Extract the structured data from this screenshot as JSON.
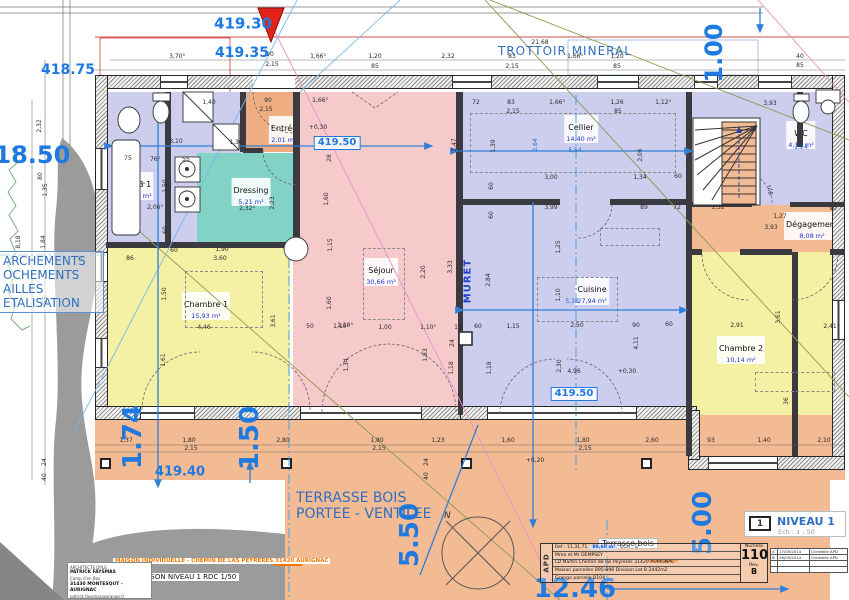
{
  "colors": {
    "lavender": "#cdcdee",
    "pink": "#f6caca",
    "yellow": "#f5f1a4",
    "teal": "#82d2c5",
    "salmon": "#f3bb94",
    "salmon_dark": "#efae82",
    "blue": "#1d6fd6"
  },
  "labels": {
    "trottoir": "TROTTOIR MINERAL",
    "muret": "MURET",
    "terrasse_line1": "TERRASSE BOIS",
    "terrasse_line2": "PORTEE - VENTILEE",
    "compass_n": "N",
    "left_box": [
      "ARCHEMENTS",
      "OCHEMENTS",
      "AILLES",
      "ETALISATION"
    ]
  },
  "rooms": [
    {
      "key": "sdb1",
      "name": "SDB 1",
      "area": "9,16 m²",
      "color": "lavender",
      "x": 106,
      "y": 92,
      "w": 62,
      "h": 153,
      "lx": 139,
      "ly": 186
    },
    {
      "key": "hall",
      "color": "lavender",
      "x": 168,
      "y": 92,
      "w": 75,
      "h": 61
    },
    {
      "key": "washcol",
      "color": "lavender",
      "x": 168,
      "y": 153,
      "w": 29,
      "h": 97
    },
    {
      "key": "dressing",
      "name": "Dressing",
      "area": "5,21 m²",
      "color": "teal",
      "x": 197,
      "y": 153,
      "w": 96,
      "h": 97,
      "lx": 251,
      "ly": 192
    },
    {
      "key": "entree",
      "name": "Entrée",
      "area": "2,01 m²",
      "color": "salmon_dark",
      "x": 243,
      "y": 92,
      "w": 57,
      "h": 60,
      "lx": 284,
      "ly": 130
    },
    {
      "key": "sejour",
      "name": "Séjour",
      "area": "30,66 m²",
      "color": "pink",
      "x": 293,
      "y": 92,
      "w": 167,
      "h": 323,
      "lx": 381,
      "ly": 272
    },
    {
      "key": "cellier",
      "name": "Cellier",
      "area": "14,40 m²",
      "color": "lavender",
      "x": 460,
      "y": 92,
      "w": 230,
      "h": 110,
      "lx": 581,
      "ly": 129
    },
    {
      "key": "cuisine",
      "name": "Cuisine",
      "area": "27,94 m²",
      "color": "lavender",
      "x": 460,
      "y": 202,
      "w": 230,
      "h": 213,
      "lx": 592,
      "ly": 291
    },
    {
      "key": "wc",
      "name": "WC",
      "area": "4,11 m²",
      "color": "lavender",
      "x": 690,
      "y": 92,
      "w": 151,
      "h": 113,
      "lx": 801,
      "ly": 135
    },
    {
      "key": "degagement",
      "name": "Dégagement",
      "area": "8,08 m²",
      "color": "salmon",
      "x": 690,
      "y": 205,
      "w": 151,
      "h": 47,
      "lx": 812,
      "ly": 226
    },
    {
      "key": "chambre2",
      "name": "Chambre 2",
      "area": "10,14 m²",
      "color": "yellow",
      "x": 690,
      "y": 252,
      "w": 102,
      "h": 204,
      "lx": 741,
      "ly": 350
    },
    {
      "key": "chambre2b",
      "color": "yellow",
      "x": 798,
      "y": 252,
      "w": 43,
      "h": 204
    },
    {
      "key": "chambre1",
      "name": "Chambre 1",
      "area": "15,93 m²",
      "color": "yellow",
      "x": 106,
      "y": 245,
      "w": 184,
      "h": 170,
      "lx": 206,
      "ly": 306
    },
    {
      "key": "terrasse-band",
      "color": "salmon",
      "x": 95,
      "y": 415,
      "w": 750,
      "h": 65
    },
    {
      "key": "terrasse-main",
      "color": "salmon",
      "x": 285,
      "y": 480,
      "w": 545,
      "h": 120
    }
  ],
  "walls": {
    "outer": [
      {
        "x": 95,
        "y": 75,
        "w": 750,
        "h": 14
      },
      {
        "x": 95,
        "y": 75,
        "w": 13,
        "h": 345
      },
      {
        "x": 95,
        "y": 406,
        "w": 375,
        "h": 14
      },
      {
        "x": 460,
        "y": 406,
        "w": 237,
        "h": 14
      },
      {
        "x": 832,
        "y": 75,
        "w": 13,
        "h": 395
      },
      {
        "x": 688,
        "y": 456,
        "w": 157,
        "h": 14
      },
      {
        "x": 688,
        "y": 410,
        "w": 12,
        "h": 50
      }
    ],
    "inner": [
      {
        "x": 165,
        "y": 92,
        "w": 6,
        "h": 153
      },
      {
        "x": 106,
        "y": 242,
        "w": 187,
        "h": 6
      },
      {
        "x": 240,
        "y": 92,
        "w": 6,
        "h": 60
      },
      {
        "x": 293,
        "y": 92,
        "w": 7,
        "h": 160
      },
      {
        "x": 243,
        "y": 148,
        "w": 20,
        "h": 5
      },
      {
        "x": 456,
        "y": 92,
        "w": 7,
        "h": 220
      },
      {
        "x": 458,
        "y": 312,
        "w": 5,
        "h": 103
      },
      {
        "x": 460,
        "y": 199,
        "w": 100,
        "h": 6
      },
      {
        "x": 610,
        "y": 199,
        "w": 80,
        "h": 6
      },
      {
        "x": 686,
        "y": 92,
        "w": 6,
        "h": 364
      },
      {
        "x": 692,
        "y": 202,
        "w": 60,
        "h": 5
      },
      {
        "x": 790,
        "y": 202,
        "w": 55,
        "h": 5
      },
      {
        "x": 692,
        "y": 249,
        "w": 10,
        "h": 6
      },
      {
        "x": 740,
        "y": 249,
        "w": 52,
        "h": 6
      },
      {
        "x": 830,
        "y": 249,
        "w": 15,
        "h": 6
      },
      {
        "x": 797,
        "y": 92,
        "w": 6,
        "h": 55
      },
      {
        "x": 792,
        "y": 252,
        "w": 6,
        "h": 204
      }
    ]
  },
  "windows": [
    {
      "x": 160,
      "y": 76,
      "w": 28,
      "h": 12
    },
    {
      "x": 253,
      "y": 76,
      "w": 42,
      "h": 12,
      "plain": 1
    },
    {
      "x": 452,
      "y": 76,
      "w": 40,
      "h": 12
    },
    {
      "x": 597,
      "y": 76,
      "w": 42,
      "h": 12
    },
    {
      "x": 694,
      "y": 76,
      "w": 24,
      "h": 12
    },
    {
      "x": 758,
      "y": 76,
      "w": 34,
      "h": 12
    },
    {
      "x": 140,
      "y": 407,
      "w": 55,
      "h": 12
    },
    {
      "x": 300,
      "y": 407,
      "w": 122,
      "h": 12
    },
    {
      "x": 487,
      "y": 407,
      "w": 150,
      "h": 12
    },
    {
      "x": 708,
      "y": 457,
      "w": 70,
      "h": 12
    },
    {
      "x": 96,
      "y": 148,
      "w": 11,
      "h": 42,
      "v": 1
    },
    {
      "x": 96,
      "y": 252,
      "w": 11,
      "h": 30,
      "v": 1
    },
    {
      "x": 96,
      "y": 338,
      "w": 11,
      "h": 30,
      "v": 1
    },
    {
      "x": 833,
      "y": 300,
      "w": 11,
      "h": 40,
      "v": 1
    }
  ],
  "dashed": [
    {
      "x": 470,
      "y": 113,
      "w": 206,
      "h": 60
    },
    {
      "x": 537,
      "y": 277,
      "w": 81,
      "h": 45
    },
    {
      "x": 363,
      "y": 248,
      "w": 42,
      "h": 72
    },
    {
      "x": 185,
      "y": 271,
      "w": 78,
      "h": 57
    },
    {
      "x": 755,
      "y": 372,
      "w": 80,
      "h": 20
    },
    {
      "x": 600,
      "y": 228,
      "w": 60,
      "h": 18
    }
  ],
  "posts": [
    {
      "x": 100,
      "y": 458
    },
    {
      "x": 281,
      "y": 458
    },
    {
      "x": 461,
      "y": 458
    },
    {
      "x": 641,
      "y": 458
    }
  ],
  "elevations": [
    {
      "t": "419.30",
      "x": 243,
      "y": 24,
      "s": 15
    },
    {
      "t": "419.35",
      "x": 242,
      "y": 53,
      "s": 14
    },
    {
      "t": "418.75",
      "x": 68,
      "y": 70,
      "s": 14
    },
    {
      "t": "418.50",
      "x": 24,
      "y": 155,
      "s": 24
    },
    {
      "t": "419.50",
      "x": 337,
      "y": 143,
      "s": 10,
      "box": 1
    },
    {
      "t": "419.50",
      "x": 574,
      "y": 394,
      "s": 10,
      "box": 1
    },
    {
      "t": "419.40",
      "x": 180,
      "y": 472,
      "s": 13
    },
    {
      "t": "1.00",
      "x": 714,
      "y": 53,
      "s": 24,
      "r": 1
    },
    {
      "t": "1.74",
      "x": 133,
      "y": 437,
      "s": 26,
      "r": 1
    },
    {
      "t": "1.50",
      "x": 250,
      "y": 438,
      "s": 26,
      "r": 1
    },
    {
      "t": "5.50",
      "x": 410,
      "y": 535,
      "s": 26,
      "r": 1
    },
    {
      "t": "5.00",
      "x": 703,
      "y": 523,
      "s": 26,
      "r": 1
    },
    {
      "t": "12.46",
      "x": 575,
      "y": 589,
      "s": 26
    }
  ],
  "dims": [
    {
      "t": "3,70⁵",
      "x": 177,
      "y": 57
    },
    {
      "t": "1,66⁵",
      "x": 318,
      "y": 57
    },
    {
      "t": "1,20",
      "x": 375,
      "y": 57
    },
    {
      "t": "85",
      "x": 375,
      "y": 67
    },
    {
      "t": "2,32",
      "x": 448,
      "y": 57
    },
    {
      "t": "83",
      "x": 512,
      "y": 57
    },
    {
      "t": "2,15",
      "x": 512,
      "y": 67
    },
    {
      "t": "21,68",
      "x": 540,
      "y": 43
    },
    {
      "t": "1,66⁵",
      "x": 575,
      "y": 57
    },
    {
      "t": "1,20",
      "x": 617,
      "y": 57
    },
    {
      "t": "85",
      "x": 617,
      "y": 67
    },
    {
      "t": "90",
      "x": 270,
      "y": 55
    },
    {
      "t": "2,15",
      "x": 272,
      "y": 65
    },
    {
      "t": "40",
      "x": 800,
      "y": 57
    },
    {
      "t": "85",
      "x": 800,
      "y": 66
    },
    {
      "t": "1,40",
      "x": 209,
      "y": 103
    },
    {
      "t": "90",
      "x": 268,
      "y": 101
    },
    {
      "t": "2,15",
      "x": 266,
      "y": 110
    },
    {
      "t": "1,66⁵",
      "x": 320,
      "y": 101
    },
    {
      "t": "72",
      "x": 476,
      "y": 103
    },
    {
      "t": "83",
      "x": 511,
      "y": 103
    },
    {
      "t": "2,15",
      "x": 513,
      "y": 112
    },
    {
      "t": "1,66⁵",
      "x": 557,
      "y": 103
    },
    {
      "t": "1,26",
      "x": 617,
      "y": 103
    },
    {
      "t": "85",
      "x": 618,
      "y": 112
    },
    {
      "t": "1,12⁵",
      "x": 663,
      "y": 103
    },
    {
      "t": "3,93",
      "x": 770,
      "y": 104
    },
    {
      "t": "3,10",
      "x": 176,
      "y": 142
    },
    {
      "t": "1,36",
      "x": 236,
      "y": 143
    },
    {
      "t": "75",
      "x": 128,
      "y": 159
    },
    {
      "t": "76⁵",
      "x": 155,
      "y": 160
    },
    {
      "t": "55",
      "x": 186,
      "y": 160
    },
    {
      "t": "1,50",
      "x": 166,
      "y": 186,
      "r": 1
    },
    {
      "t": "2,06⁵",
      "x": 155,
      "y": 208
    },
    {
      "t": "2,32⁵",
      "x": 247,
      "y": 209
    },
    {
      "t": "2,23",
      "x": 273,
      "y": 203,
      "r": 1
    },
    {
      "t": "1,60",
      "x": 327,
      "y": 199,
      "r": 1
    },
    {
      "t": "28",
      "x": 330,
      "y": 158,
      "r": 1
    },
    {
      "t": "60",
      "x": 166,
      "y": 230,
      "r": 1
    },
    {
      "t": "+0,30",
      "x": 318,
      "y": 128
    },
    {
      "t": "2,32",
      "x": 40,
      "y": 126,
      "r": 1
    },
    {
      "t": "80",
      "x": 41,
      "y": 176,
      "r": 1
    },
    {
      "t": "1,35",
      "x": 46,
      "y": 190,
      "r": 1
    },
    {
      "t": "8,18",
      "x": 19,
      "y": 242,
      "r": 1
    },
    {
      "t": "1,84",
      "x": 44,
      "y": 242,
      "r": 1
    },
    {
      "t": "85",
      "x": 81,
      "y": 260
    },
    {
      "t": "55",
      "x": 46,
      "y": 300,
      "r": 1
    },
    {
      "t": "24",
      "x": 45,
      "y": 462,
      "r": 1
    },
    {
      "t": "40",
      "x": 45,
      "y": 477,
      "r": 1
    },
    {
      "t": "1,39",
      "x": 494,
      "y": 146,
      "r": 1
    },
    {
      "t": "2,64",
      "x": 536,
      "y": 145,
      "r": 1,
      "b": 1
    },
    {
      "t": "5,54",
      "x": 575,
      "y": 151,
      "b": 1
    },
    {
      "t": "2,47",
      "x": 455,
      "y": 145,
      "r": 1
    },
    {
      "t": "3,00",
      "x": 551,
      "y": 178
    },
    {
      "t": "1,34",
      "x": 640,
      "y": 178
    },
    {
      "t": "60",
      "x": 678,
      "y": 177
    },
    {
      "t": "3,99",
      "x": 551,
      "y": 208
    },
    {
      "t": "89",
      "x": 644,
      "y": 208
    },
    {
      "t": "72",
      "x": 677,
      "y": 208
    },
    {
      "t": "2,06",
      "x": 641,
      "y": 155,
      "r": 1
    },
    {
      "t": "60",
      "x": 492,
      "y": 186,
      "r": 1
    },
    {
      "t": "60",
      "x": 492,
      "y": 215,
      "r": 1
    },
    {
      "t": "2,24",
      "x": 801,
      "y": 148,
      "b": 1
    },
    {
      "t": "1,52",
      "x": 718,
      "y": 208
    },
    {
      "t": "1,27",
      "x": 780,
      "y": 217
    },
    {
      "t": "3,93",
      "x": 771,
      "y": 228
    },
    {
      "t": "90",
      "x": 833,
      "y": 209
    },
    {
      "t": "97⁵",
      "x": 772,
      "y": 190,
      "r": 1
    },
    {
      "t": "2,20",
      "x": 424,
      "y": 272,
      "r": 1
    },
    {
      "t": "3,33",
      "x": 451,
      "y": 267,
      "r": 1
    },
    {
      "t": "2,84",
      "x": 489,
      "y": 280,
      "r": 1
    },
    {
      "t": "1,10⁵",
      "x": 341,
      "y": 327
    },
    {
      "t": "1,00",
      "x": 385,
      "y": 328
    },
    {
      "t": "1,10⁵",
      "x": 428,
      "y": 328
    },
    {
      "t": "13",
      "x": 458,
      "y": 328
    },
    {
      "t": "60",
      "x": 478,
      "y": 327
    },
    {
      "t": "1,15",
      "x": 513,
      "y": 327
    },
    {
      "t": "24",
      "x": 453,
      "y": 343,
      "r": 1
    },
    {
      "t": "1,83",
      "x": 426,
      "y": 355,
      "r": 1
    },
    {
      "t": "1,18",
      "x": 452,
      "y": 368,
      "r": 1
    },
    {
      "t": "1,18",
      "x": 490,
      "y": 368,
      "r": 1
    },
    {
      "t": "2,50",
      "x": 577,
      "y": 326
    },
    {
      "t": "90",
      "x": 636,
      "y": 326
    },
    {
      "t": "60",
      "x": 669,
      "y": 325
    },
    {
      "t": "4,11",
      "x": 637,
      "y": 343,
      "r": 1
    },
    {
      "t": "1,10",
      "x": 559,
      "y": 295,
      "r": 1
    },
    {
      "t": "5,38",
      "x": 572,
      "y": 302,
      "b": 1
    },
    {
      "t": "1,25",
      "x": 559,
      "y": 247,
      "r": 1
    },
    {
      "t": "2,30",
      "x": 560,
      "y": 366,
      "r": 1
    },
    {
      "t": "4,96",
      "x": 574,
      "y": 372
    },
    {
      "t": "+0,30",
      "x": 627,
      "y": 372
    },
    {
      "t": "86",
      "x": 130,
      "y": 259
    },
    {
      "t": "60",
      "x": 174,
      "y": 251
    },
    {
      "t": "1,90",
      "x": 222,
      "y": 250
    },
    {
      "t": "3,60",
      "x": 220,
      "y": 259
    },
    {
      "t": "1,50",
      "x": 165,
      "y": 294,
      "r": 1
    },
    {
      "t": "4,46",
      "x": 204,
      "y": 328
    },
    {
      "t": "3,61",
      "x": 274,
      "y": 321,
      "r": 1
    },
    {
      "t": "1,61",
      "x": 164,
      "y": 360,
      "r": 1
    },
    {
      "t": "50",
      "x": 310,
      "y": 327
    },
    {
      "t": "1,10⁵",
      "x": 345,
      "y": 326
    },
    {
      "t": "1,15",
      "x": 331,
      "y": 245,
      "r": 1
    },
    {
      "t": "1,60",
      "x": 330,
      "y": 303,
      "r": 1
    },
    {
      "t": "1,34",
      "x": 347,
      "y": 365,
      "r": 1
    },
    {
      "t": "2,91",
      "x": 737,
      "y": 326
    },
    {
      "t": "3,61",
      "x": 779,
      "y": 317,
      "r": 1
    },
    {
      "t": "36",
      "x": 787,
      "y": 401,
      "r": 1
    },
    {
      "t": "2,41",
      "x": 830,
      "y": 327
    },
    {
      "t": "1,37",
      "x": 126,
      "y": 441
    },
    {
      "t": "1,80",
      "x": 189,
      "y": 441
    },
    {
      "t": "2,15",
      "x": 191,
      "y": 449
    },
    {
      "t": "2,80",
      "x": 283,
      "y": 441
    },
    {
      "t": "1,80",
      "x": 377,
      "y": 441
    },
    {
      "t": "2,15",
      "x": 379,
      "y": 449
    },
    {
      "t": "1,23",
      "x": 438,
      "y": 441
    },
    {
      "t": "1,60",
      "x": 508,
      "y": 441
    },
    {
      "t": "1,80",
      "x": 583,
      "y": 441
    },
    {
      "t": "2,15",
      "x": 585,
      "y": 449
    },
    {
      "t": "2,60",
      "x": 652,
      "y": 441
    },
    {
      "t": "93",
      "x": 711,
      "y": 441
    },
    {
      "t": "1,40",
      "x": 764,
      "y": 441
    },
    {
      "t": "2,10",
      "x": 824,
      "y": 441
    },
    {
      "t": "+0,20",
      "x": 535,
      "y": 461
    },
    {
      "t": "24",
      "x": 427,
      "y": 462,
      "r": 1
    },
    {
      "t": "40",
      "x": 427,
      "y": 476,
      "r": 1
    }
  ],
  "projstrip": {
    "project_line": "MAISON INDIVIDUELLE  -  CHEMIN DE LAS PEYRERES 31420 AURIGNAC",
    "plan_line": "PLAN MAISON NIVEAU 1 RDC  1/50"
  },
  "architect": {
    "line1": "ARCHITECTE DPLG",
    "line2": "PATRICK FAYSMAS",
    "line3": "Camp d'en Bas",
    "line4": "31430 MONTESQUT - AURIGNAC",
    "line5": "patrick.faysmas@orange.fr"
  },
  "titleblock": {
    "phase": "APD",
    "chip": "Terrasse bois",
    "ref": "Ref : 11.31.71",
    "area": "89,60 m²",
    "ech": "ECH : 1/",
    "client": "Mme et Mr DEMPSEY",
    "addr1": "LD Martin Chemin de las Peyreres 31420 AURIGNAC",
    "addr2": "Maison parcelles B95-B96 Division Lot B 2442m2",
    "addr3": "Grange parcelle B104",
    "numero_label": "Numero",
    "numero": "110",
    "rev_label": "Rev.",
    "rev": "B",
    "revisions": [
      {
        "rev": "A",
        "date": "17/05/2014",
        "by": "Christelle APD"
      },
      {
        "rev": "B",
        "date": "26/05/2014",
        "by": "Christelle APD"
      }
    ]
  },
  "niveau": {
    "num": "1",
    "title": "NIVEAU 1",
    "ech": "Ech :  1 : 50"
  }
}
